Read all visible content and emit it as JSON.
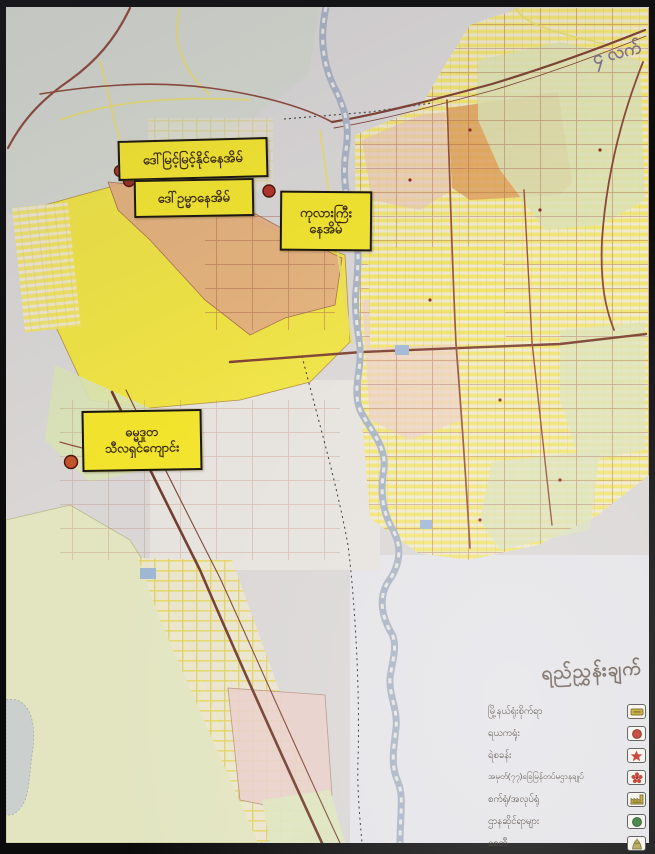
{
  "map": {
    "annotations": [
      {
        "text": "ဒေါ်မြင့်မြင့်နိုင်နေအိမ်"
      },
      {
        "text": "ဒေါ်ဥမ္မာနေအိမ်"
      },
      {
        "line1": "ကုလားကြီး",
        "line2": "နေအိမ်"
      },
      {
        "line1": "ဓမ္မဒူတ",
        "line2": "သီလရှင်ကျောင်း"
      }
    ],
    "corner_text": "၄ လက်",
    "legend": {
      "title": "ရည်ညွှန်းချက်",
      "items": [
        {
          "label": "မြို့နယ်ရုံးစိုက်ရာ",
          "symbol": "township-office"
        },
        {
          "label": "ရယကရုံး",
          "symbol": "ward-office"
        },
        {
          "label": "ရဲစခန်း",
          "symbol": "police-station"
        },
        {
          "label": "အမှတ်(၇၇)ခြေမြန်တပ်မဌာနချုပ်",
          "symbol": "military-hq"
        },
        {
          "label": "စက်ရုံ/အလုပ်ရုံ",
          "symbol": "factory"
        },
        {
          "label": "ဌာနဆိုင်ရာများ",
          "symbol": "departments"
        },
        {
          "label": "စေတီ",
          "symbol": "pagoda"
        }
      ]
    },
    "colors": {
      "label_bg": "#f2e42c",
      "marker": "#b03226",
      "river": "#a8b2c2",
      "zone_yellow": "#f1e43c",
      "zone_salmon": "#e2ad80",
      "zone_orange": "#df9c58",
      "zone_green": "#dce2b4",
      "zone_pink": "#eccfc6",
      "road": "#8a4636"
    }
  }
}
